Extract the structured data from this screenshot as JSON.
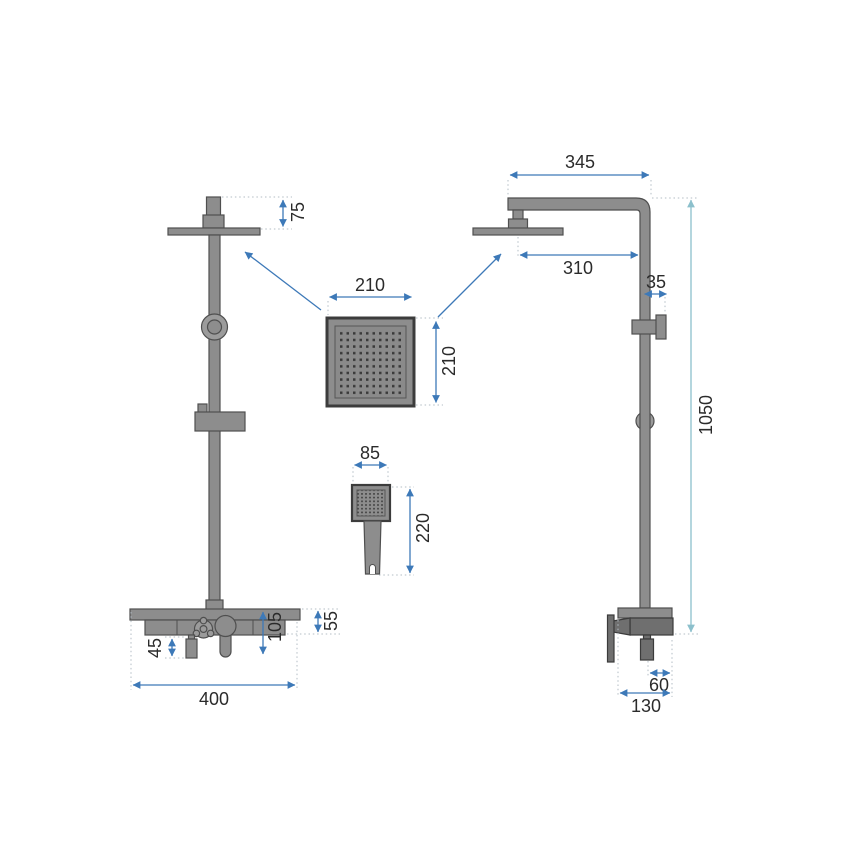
{
  "drawing": {
    "kind": "shower-column-dimension-drawing",
    "unit_labels_visible": false
  },
  "colors": {
    "background": "#ffffff",
    "fixture_fill": "#8d8d8d",
    "fixture_dark": "#6f6f6f",
    "outline": "#4f4f4f",
    "dimension_blue": "#3d79b8",
    "dimension_teal": "#8cc0cc",
    "extension_grey": "#b3bcc4",
    "text": "#2b2b2b"
  },
  "dims": {
    "head_drop": "75",
    "arm_span": "345",
    "arm_reach": "310",
    "wall_offset": "35",
    "rain_head_width": "210",
    "rain_head_depth": "210",
    "column_height": "1050",
    "hand_head_width": "85",
    "hand_shower_length": "220",
    "shelf_drop": "55",
    "mixer_drop": "105",
    "outlet_drop": "45",
    "shelf_width": "400",
    "outlet_offset": "60",
    "mixer_depth": "130"
  }
}
